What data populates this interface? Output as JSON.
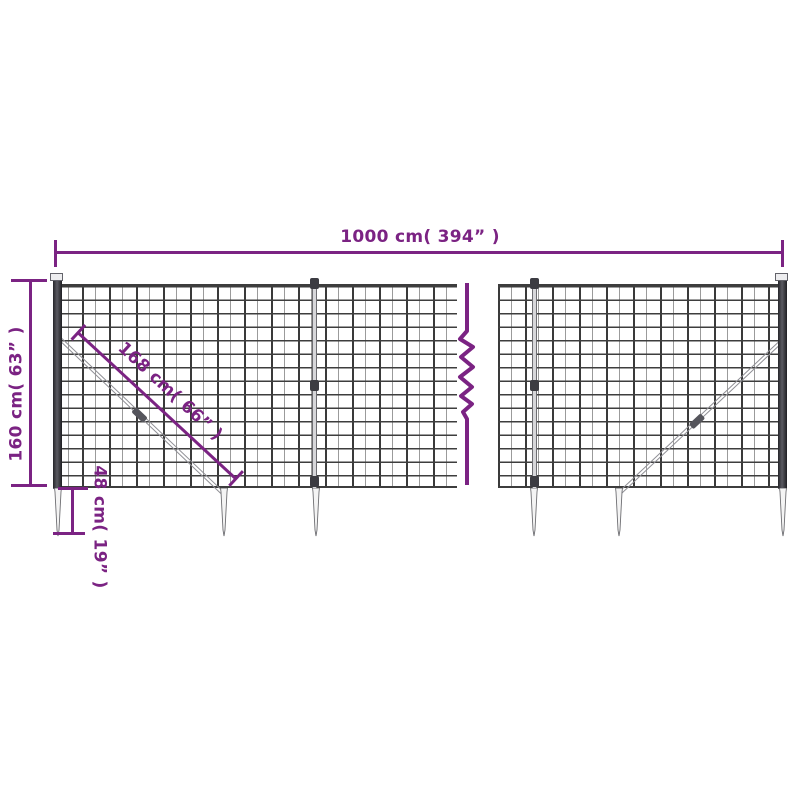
{
  "meta": {
    "accent_color": "#7b2383",
    "mesh_color": "#3e3e3e",
    "post_color": "#2a2a2e",
    "background": "#ffffff"
  },
  "diagram": {
    "type": "product-dimension-diagram",
    "subject": "wire mesh fence with ground anchor spikes",
    "dimensions": {
      "width": {
        "label": "1000 cm( 394” )"
      },
      "height": {
        "label": "160 cm( 63” )"
      },
      "diagonal_brace": {
        "label": "168 cm( 66” )"
      },
      "spike_depth": {
        "label": "48 cm( 19” )"
      }
    }
  }
}
